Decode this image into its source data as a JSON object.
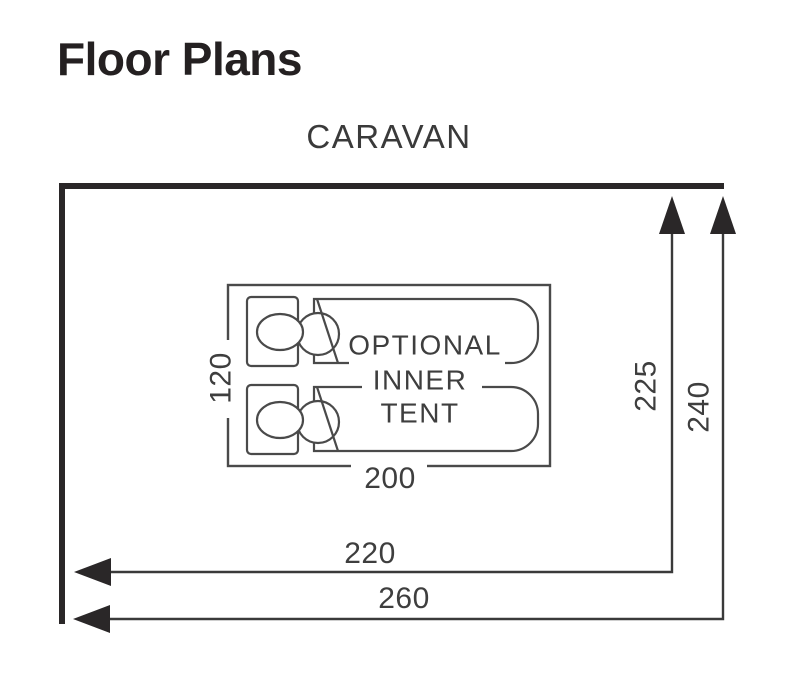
{
  "title": "Floor Plans",
  "plan": {
    "heading": "CARAVAN",
    "inner_tent": {
      "label_line1": "OPTIONAL",
      "label_line2": "INNER",
      "label_line3": "TENT",
      "width_cm": "200",
      "depth_cm": "120"
    },
    "awning": {
      "inner_depth_cm": "225",
      "outer_depth_cm": "240",
      "inner_width_cm": "220",
      "outer_width_cm": "260"
    }
  },
  "colors": {
    "background": "#ffffff",
    "wall": "#2a2728",
    "dimension_line": "#3a3a3a",
    "outline": "#4a4a4a",
    "label_text": "#3e3e3e",
    "title_text": "#242021"
  }
}
